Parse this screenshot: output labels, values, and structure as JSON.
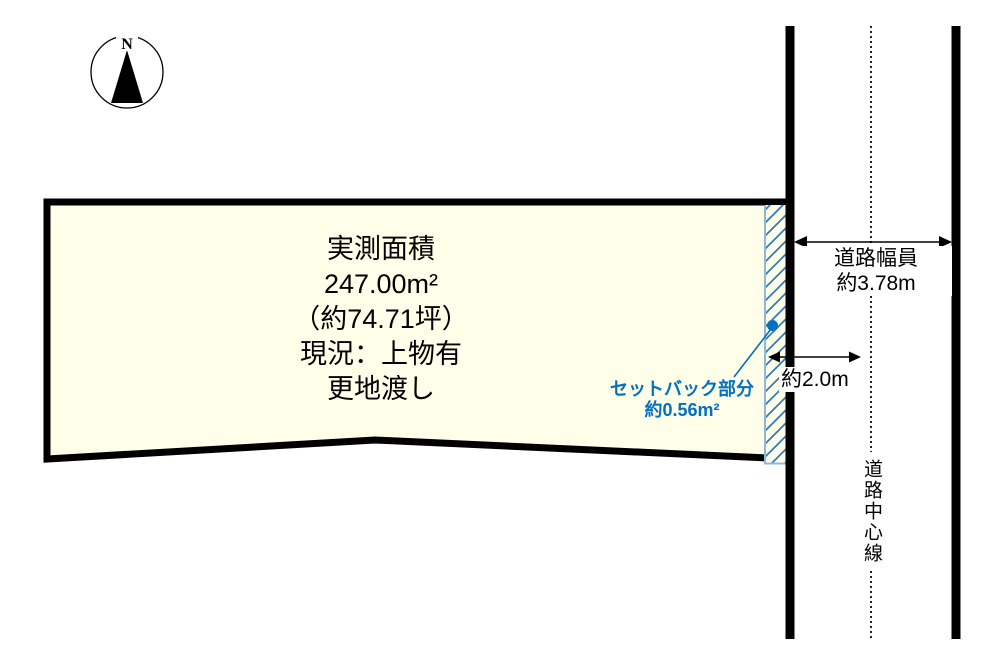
{
  "compass": {
    "label": "N"
  },
  "plot": {
    "fill_color": "#FFFEE9",
    "border_color": "#000000",
    "lines": [
      "実測面積",
      "247.00m²",
      "（約74.71坪）",
      "現況：上物有",
      "更地渡し"
    ]
  },
  "setback": {
    "label_line1": "セットバック部分",
    "label_line2": "約0.56m²",
    "text_color": "#0070C0",
    "hatch_color": "#2E78BE",
    "strip_border_color": "#8FB8DC"
  },
  "road": {
    "width_label_line1": "道路幅員",
    "width_label_line2": "約3.78m",
    "setback_distance_label": "約2.0m",
    "centerline_label": "道路中心線",
    "line_color": "#000000"
  }
}
